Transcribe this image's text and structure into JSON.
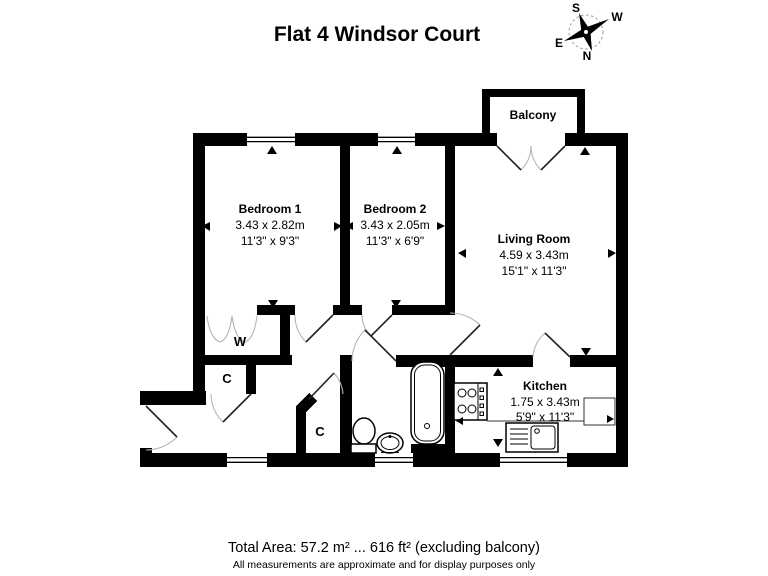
{
  "title": "Flat 4 Windsor Court",
  "compass": {
    "n": "N",
    "s": "S",
    "e": "E",
    "w": "W"
  },
  "rooms": {
    "bedroom1": {
      "name": "Bedroom 1",
      "metric": "3.43 x 2.82m",
      "imperial": "11'3\" x 9'3\""
    },
    "bedroom2": {
      "name": "Bedroom 2",
      "metric": "3.43 x 2.05m",
      "imperial": "11'3\" x 6'9\""
    },
    "living_room": {
      "name": "Living Room",
      "metric": "4.59 x 3.43m",
      "imperial": "15'1\" x 11'3\""
    },
    "kitchen": {
      "name": "Kitchen",
      "metric": "1.75 x 3.43m",
      "imperial": "5'9\" x 11'3\""
    },
    "balcony": {
      "name": "Balcony"
    },
    "wardrobe": {
      "label": "W"
    },
    "cupboard_hall": {
      "label": "C"
    },
    "cupboard_bath": {
      "label": "C"
    }
  },
  "footer": {
    "total_area": "Total Area: 57.2 m² ... 616 ft² (excluding balcony)",
    "disclaimer": "All measurements are approximate and for display purposes only"
  },
  "fixtures": [
    "bath",
    "toilet",
    "wash-basin",
    "hob",
    "sink-drainer"
  ],
  "colors": {
    "wall": "#000000",
    "background": "#ffffff",
    "text": "#000000",
    "door_arc": "#b5b5b5"
  }
}
